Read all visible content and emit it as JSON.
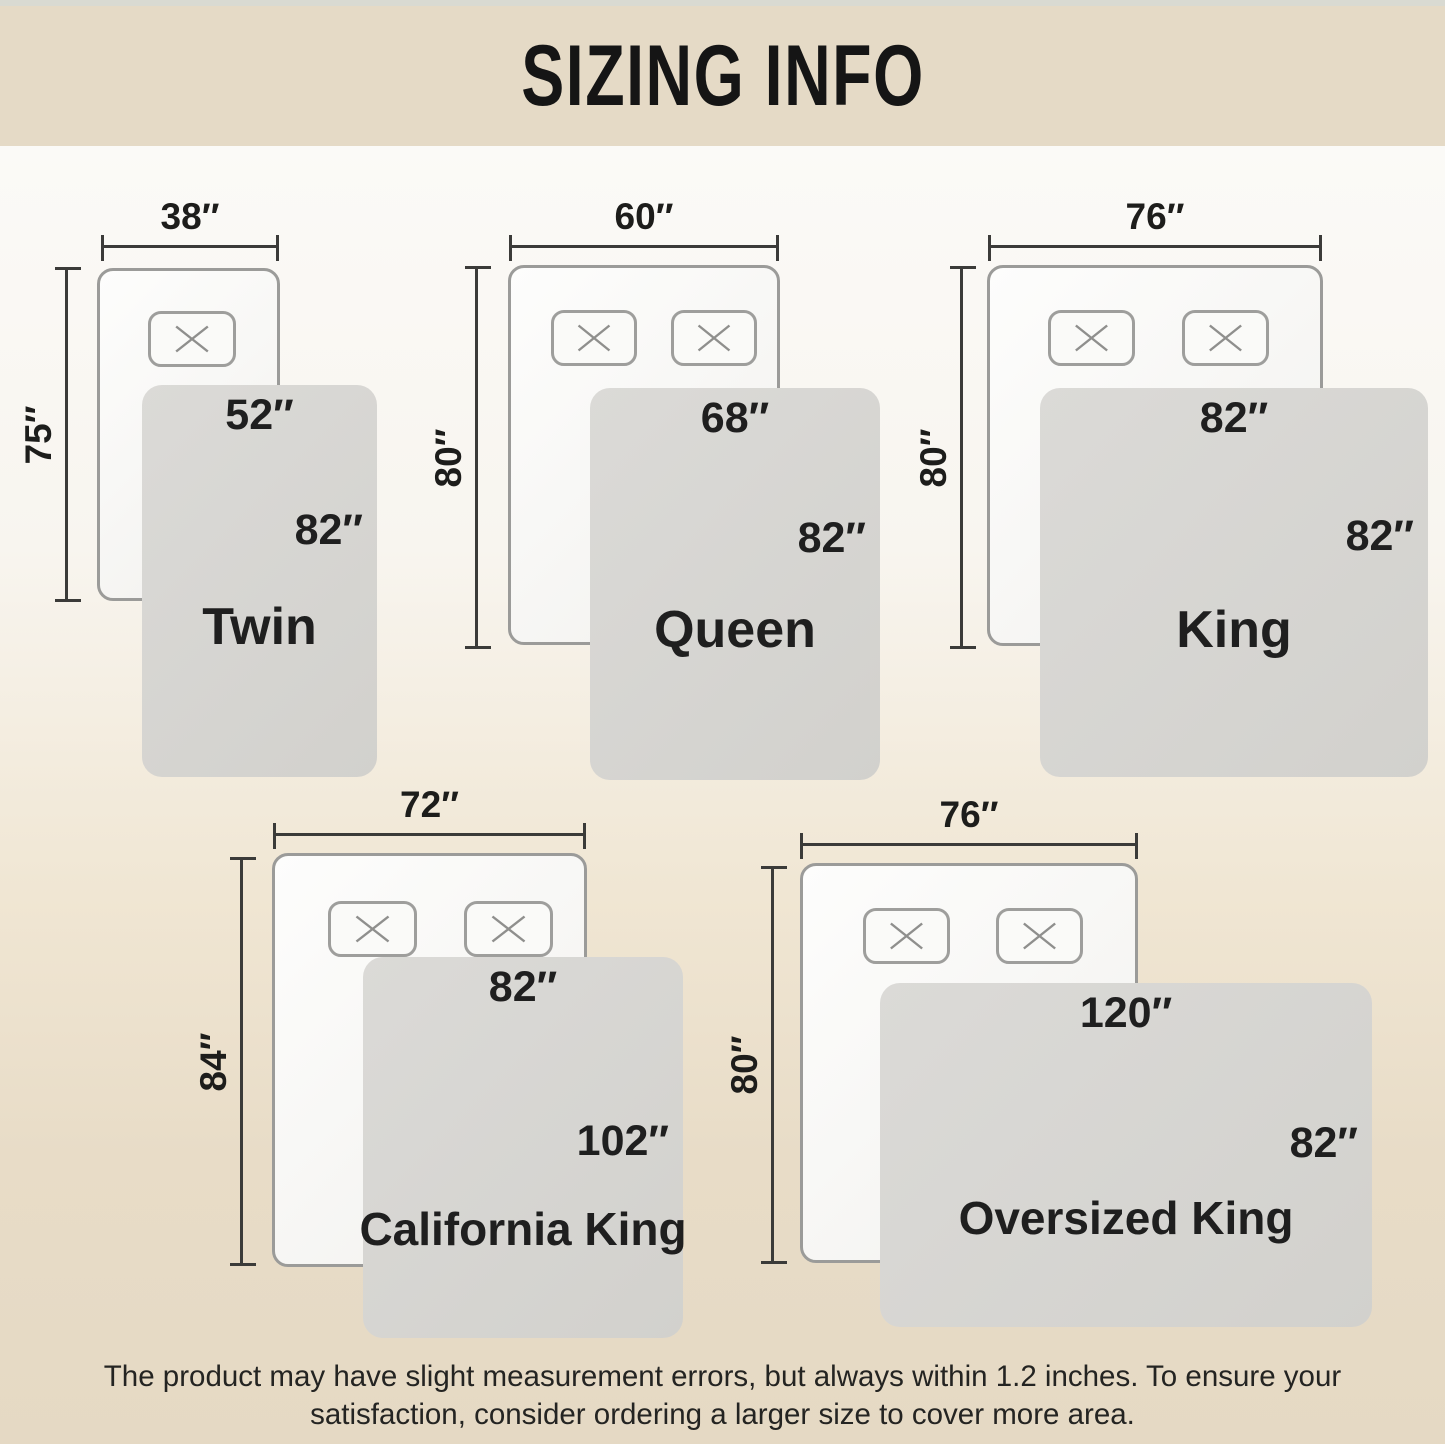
{
  "title": "SIZING INFO",
  "beds": [
    {
      "name": "Twin",
      "mattress_width": "38″",
      "mattress_length": "75″",
      "blanket_width": "52″",
      "blanket_length": "82″"
    },
    {
      "name": "Queen",
      "mattress_width": "60″",
      "mattress_length": "80″",
      "blanket_width": "68″",
      "blanket_length": "82″"
    },
    {
      "name": "King",
      "mattress_width": "76″",
      "mattress_length": "80″",
      "blanket_width": "82″",
      "blanket_length": "82″"
    },
    {
      "name": "California King",
      "mattress_width": "72″",
      "mattress_length": "84″",
      "blanket_width": "82″",
      "blanket_length": "102″"
    },
    {
      "name": "Oversized King",
      "mattress_width": "76″",
      "mattress_length": "80″",
      "blanket_width": "120″",
      "blanket_length": "82″"
    }
  ],
  "footnote": "The product may have slight measurement errors, but always within 1.2 inches. To ensure your satisfaction, consider ordering a larger size to cover more area.",
  "colors": {
    "header_band": "#e5dac6",
    "top_strip": "#d9dad2",
    "background_top": "#fbfaf7",
    "background_bottom": "#e5d9c4",
    "mattress_fill": "#f8f7f4",
    "mattress_outline": "#9b9b99",
    "blanket_fill": "#d6d5d2",
    "dimension_line": "#3b3b39",
    "text": "#1f1f1f"
  }
}
